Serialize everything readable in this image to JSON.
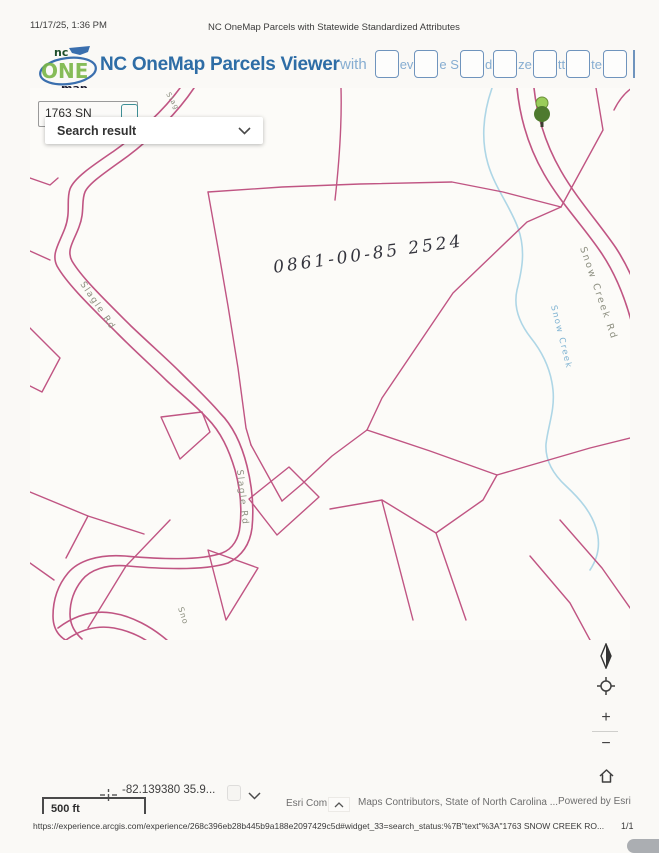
{
  "print_header": {
    "datetime": "11/17/25, 1:36 PM",
    "title": "NC OneMap Parcels with Statewide Standardized Attributes"
  },
  "app_header": {
    "logo": {
      "nc": "nc",
      "one": "ONE",
      "map": "map"
    },
    "title": "NC OneMap Parcels Viewer",
    "subtitle_prefix": "with",
    "subtitle_fragments": {
      "f0": "ev",
      "f1": "e S",
      "f2": "d",
      "f3": "ze",
      "f4": "tt",
      "f5": "te"
    }
  },
  "search": {
    "input_value": "1763 SN",
    "result_label": "Search result"
  },
  "map": {
    "parcel_number_annotation": "0861-00-85 2524",
    "labels": {
      "slagle_rd_upper": "Slagle Rd",
      "slagle_rd_mid": "Slagle Rd",
      "snow_creek_rd": "Snow Creek Rd",
      "snow_creek": "Snow Creek",
      "road_cut_bottom": "Sno",
      "road_cut_top": "Slag"
    },
    "colors": {
      "parcel_line": "#c05583",
      "creek": "#aed6e6",
      "road_label": "#8d8f80",
      "creek_label": "#7fb3d2",
      "handwriting": "#33333c",
      "tree_light": "#9acd5a",
      "tree_dark": "#4e7a2e"
    }
  },
  "controls": {
    "zoom_in": "+",
    "zoom_out": "−"
  },
  "icons": {
    "search_dropdown": "chevron-down",
    "compass": "compass-needle",
    "locate": "crosshair-circle",
    "home": "house",
    "coordinates": "crosshair",
    "attribution_expand": "chevron-up",
    "coordinates_expand": "chevron-down",
    "tree_marker": "tree"
  },
  "statusbar": {
    "coordinates": "-82.139380 35.9...",
    "scale": "500 ft",
    "esri_attribution": "Esri Com",
    "contributors": "Maps Contributors, State of North Carolina ...",
    "powered_by": "Powered by Esri"
  },
  "footer": {
    "url": "https://experience.arcgis.com/experience/268c396eb28b445b9a188e2097429c5d#widget_33=search_status:%7B\"text\"%3A\"1763 SNOW CREEK RO...",
    "page_number": "1/1"
  }
}
